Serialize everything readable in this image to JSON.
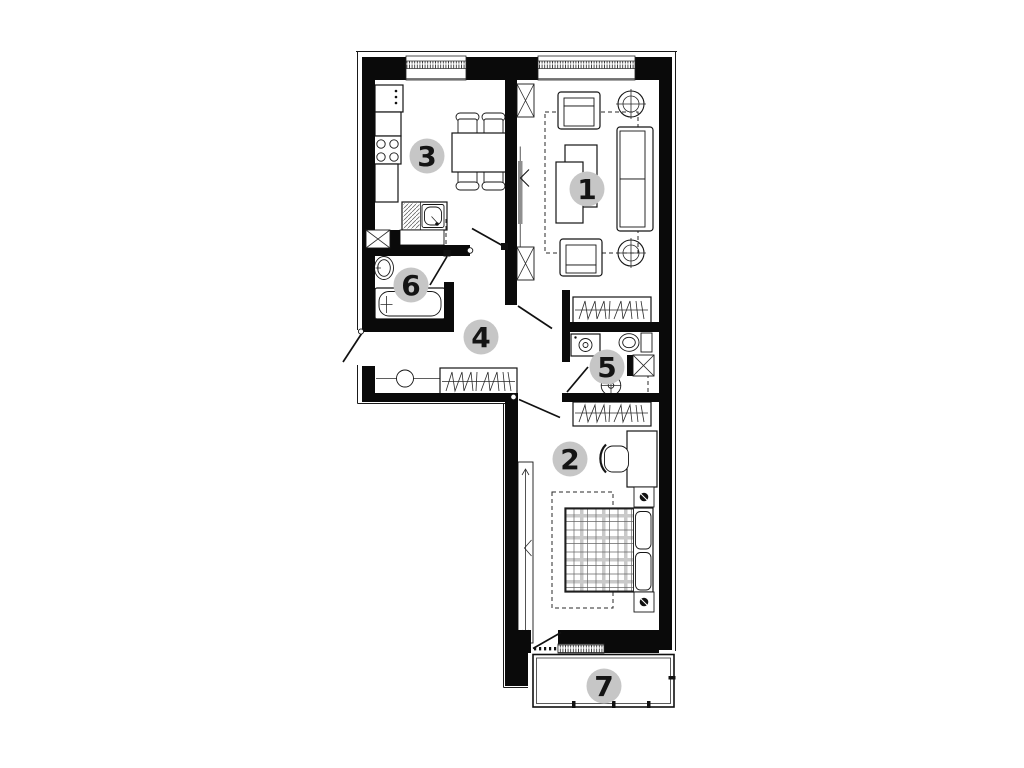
{
  "floor_plan": {
    "room_labels": [
      {
        "number": "1",
        "x": 587,
        "y": 189
      },
      {
        "number": "2",
        "x": 570,
        "y": 459
      },
      {
        "number": "3",
        "x": 427,
        "y": 156
      },
      {
        "number": "4",
        "x": 481,
        "y": 337
      },
      {
        "number": "5",
        "x": 607,
        "y": 367
      },
      {
        "number": "6",
        "x": 411,
        "y": 285
      },
      {
        "number": "7",
        "x": 604,
        "y": 686
      }
    ],
    "colors": {
      "background": "#ffffff",
      "walls": "#0a0a0a",
      "label_circle": "#c6c6c6",
      "label_number": "#141414",
      "sliding_door": "#8f8f8f",
      "window_tick": "#333333"
    }
  }
}
